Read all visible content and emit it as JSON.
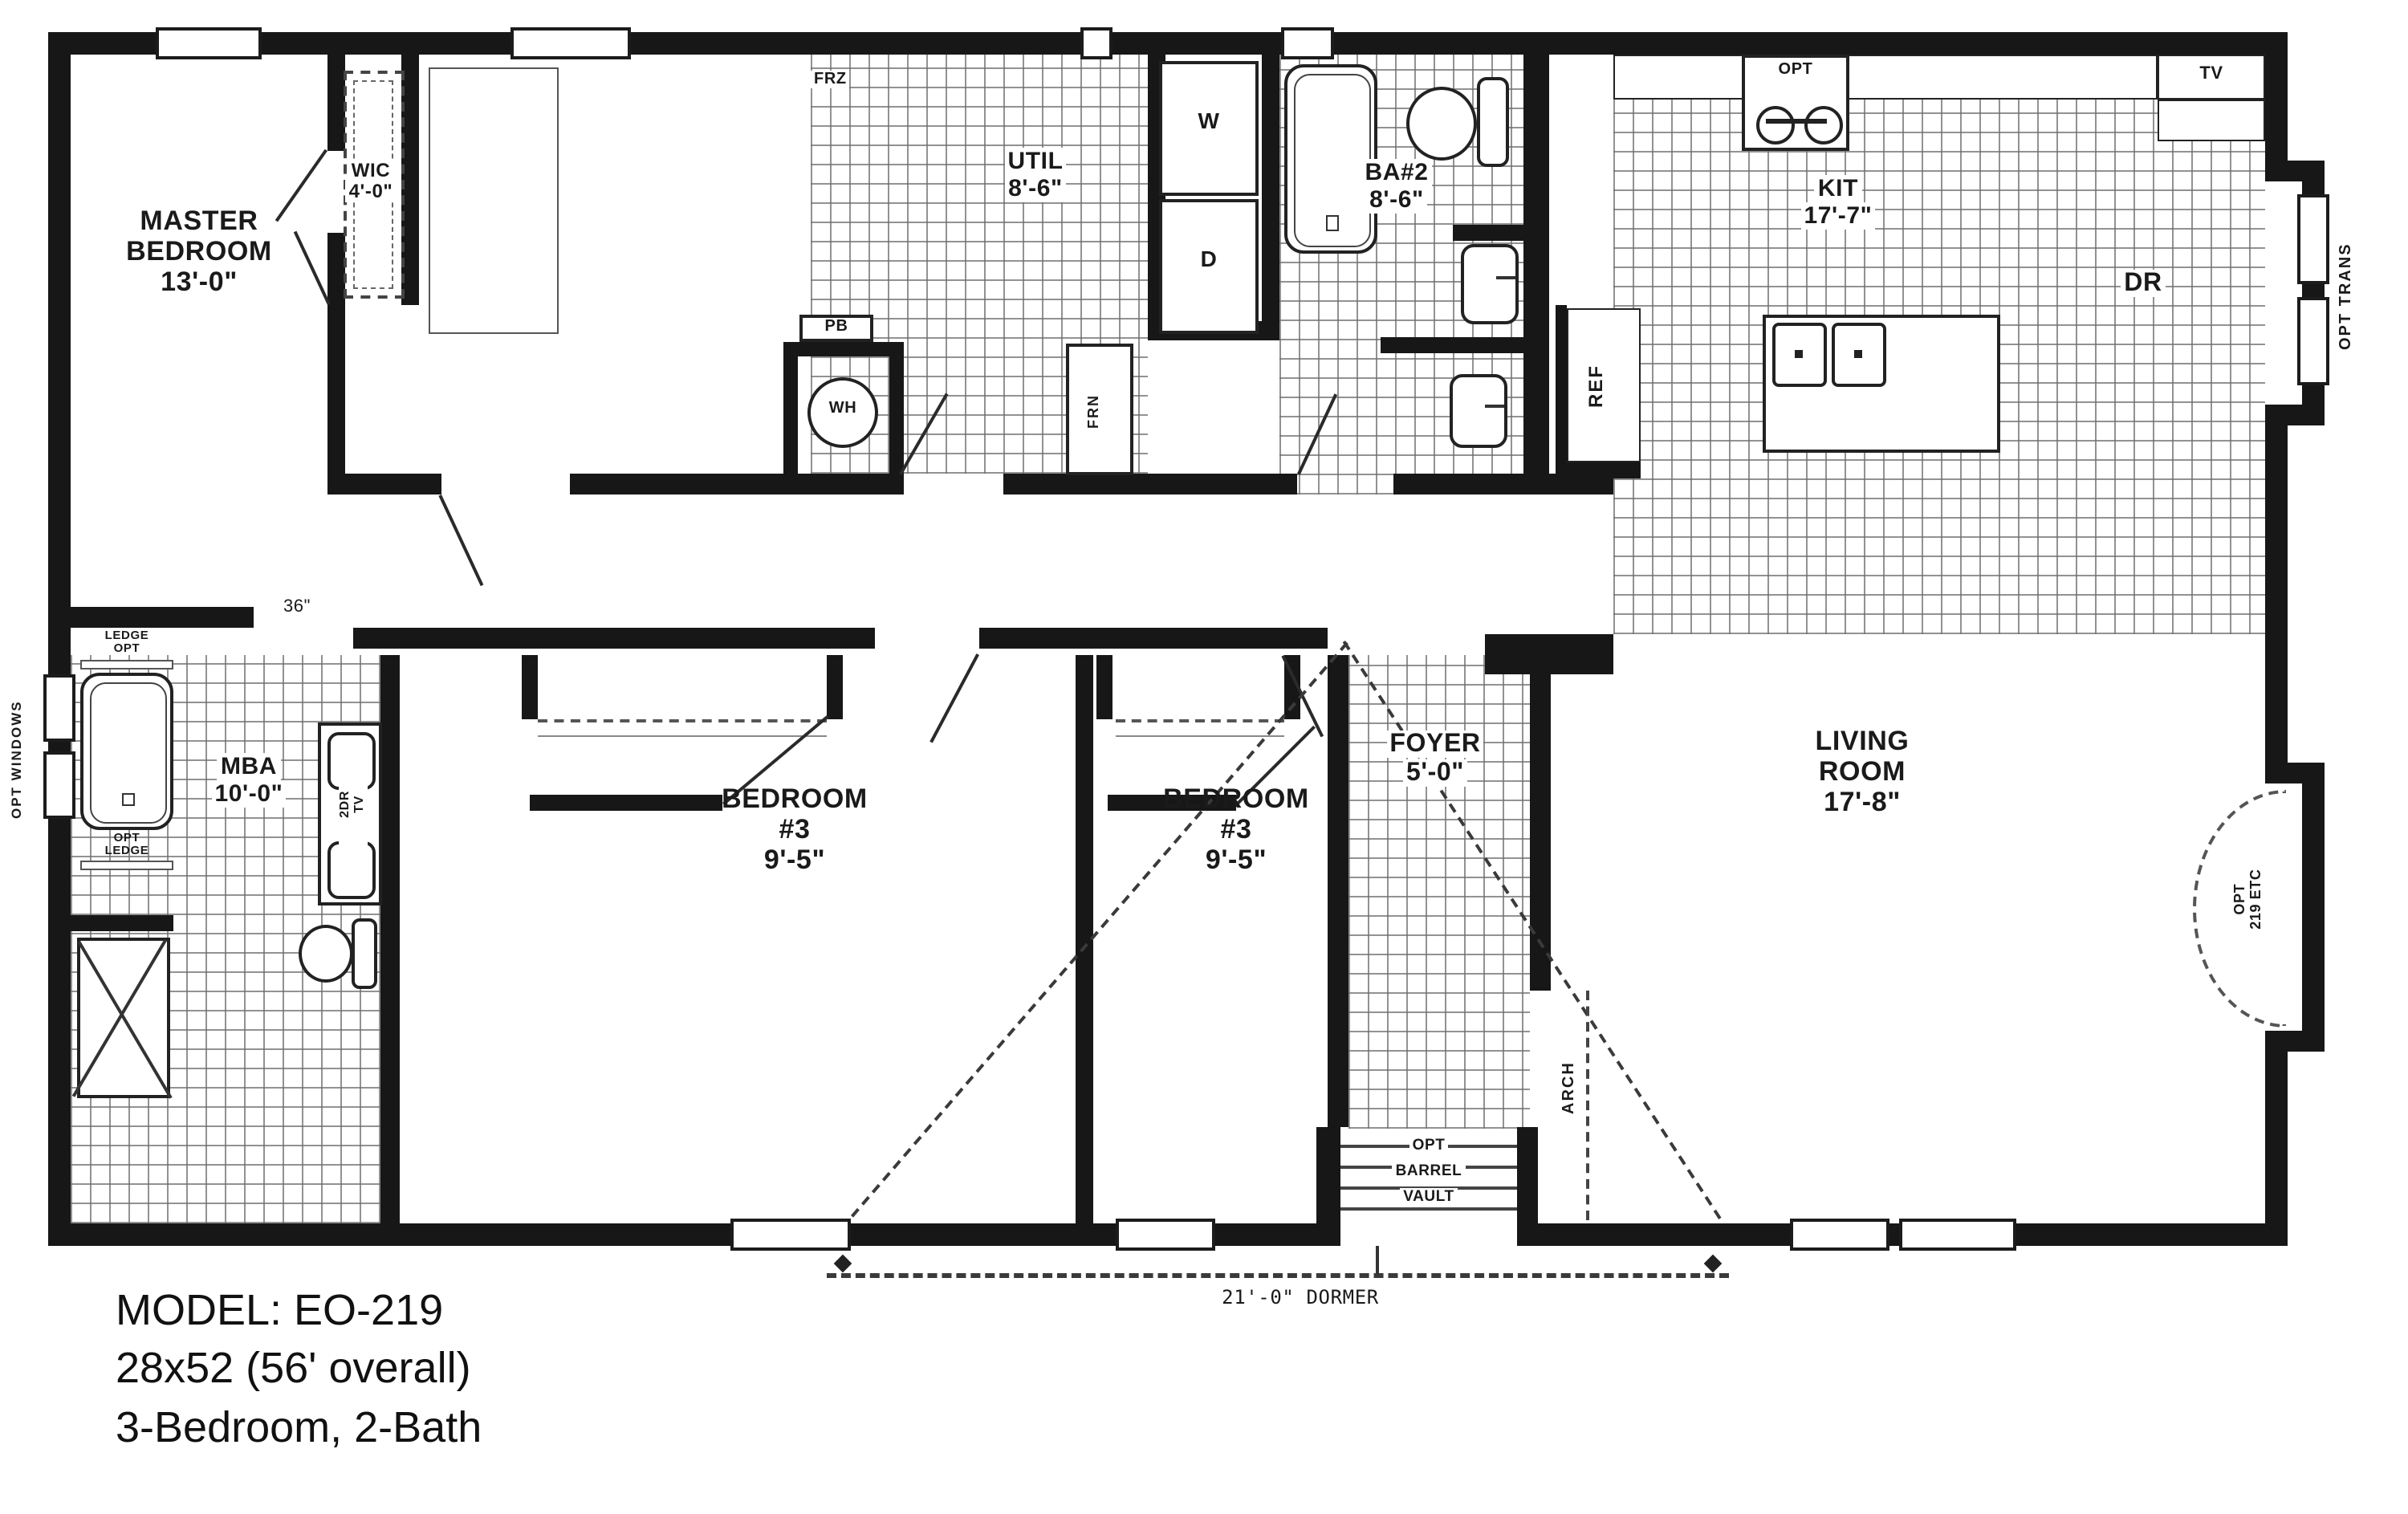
{
  "rooms": {
    "master": {
      "lines": [
        "MASTER",
        "BEDROOM",
        "13'-0\""
      ]
    },
    "wic": {
      "lines": [
        "WIC",
        "4'-0\""
      ]
    },
    "util": {
      "lines": [
        "UTIL",
        "8'-6\""
      ]
    },
    "ba2": {
      "lines": [
        "BA#2",
        "8'-6\""
      ]
    },
    "kit": {
      "lines": [
        "KIT",
        "17'-7\""
      ]
    },
    "dr": {
      "label": "DR"
    },
    "mba": {
      "lines": [
        "MBA",
        "10'-0\""
      ]
    },
    "bed3a": {
      "lines": [
        "BEDROOM",
        "#3",
        "9'-5\""
      ]
    },
    "bed3b": {
      "lines": [
        "BEDROOM",
        "#3",
        "9'-5\""
      ]
    },
    "foyer": {
      "lines": [
        "FOYER",
        "5'-0\""
      ]
    },
    "living": {
      "lines": [
        "LIVING",
        "ROOM",
        "17'-8\""
      ]
    }
  },
  "fixtures": {
    "frz": "FRZ",
    "washer": "W",
    "dryer": "D",
    "pb": "PB",
    "wh": "WH",
    "frn": "FRN",
    "ref": "REF",
    "tv": "TV",
    "opt_range": "OPT",
    "sink_tv": {
      "lines": [
        "2DR",
        "TV"
      ]
    }
  },
  "annotations": {
    "opt_trans": "OPT TRANS",
    "opt_windows": "OPT WINDOWS",
    "ledge_opt": {
      "lines": [
        "LEDGE",
        "OPT"
      ]
    },
    "opt_ledge": {
      "lines": [
        "OPT",
        "LEDGE"
      ]
    },
    "opening_36": "36\"",
    "arch": "ARCH",
    "opt_219": {
      "lines": [
        "OPT",
        "219 ETC"
      ]
    },
    "barrel": {
      "lines": [
        "OPT",
        "BARREL",
        "VAULT"
      ]
    },
    "dormer": "21'-0\" DORMER"
  },
  "footer": {
    "lines": [
      "MODEL: EO-219",
      "28x52 (56' overall)",
      "3-Bedroom, 2-Bath"
    ]
  },
  "colors": {
    "wall": "#171717",
    "tile_line": "#6e6e6e"
  }
}
